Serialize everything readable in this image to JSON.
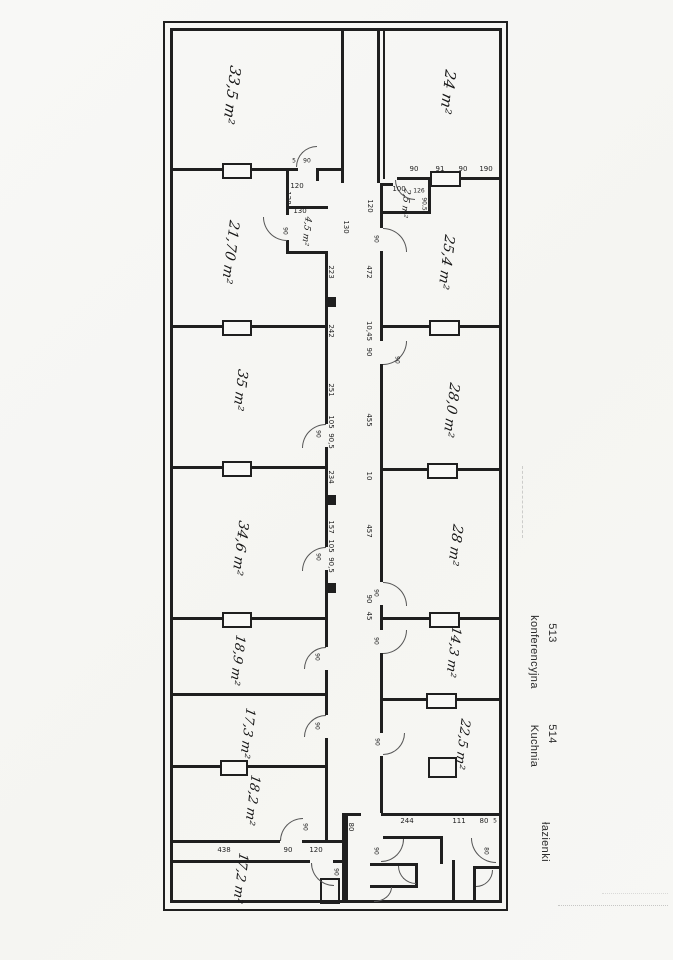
{
  "rooms": {
    "a335": "33,5 m²",
    "a24": "24 m²",
    "a2170": "21,70 m²",
    "a45": "4,5 m²",
    "a25": "2,5 m²",
    "a254": "25,4 m²",
    "a35": "35 m²",
    "a280": "28,0 m²",
    "a346": "34,6 m²",
    "a28": "28 m²",
    "a189": "18,9 m²",
    "a143": "14,3 m²",
    "a173": "17,3 m²",
    "a225": "22,5 m²",
    "a182": "18,2 m²",
    "a172": "17,2 m²"
  },
  "side_labels": {
    "room1_number": "513",
    "room1_name": "konferencyjna",
    "room2_number": "514",
    "room2_name": "Kuchnia",
    "bath": "łazienki"
  },
  "dims": {
    "corridor_left": [
      "130",
      "223",
      "242",
      "251",
      "105",
      "90,5",
      "234",
      "157",
      "105",
      "90,5"
    ],
    "corridor_right": [
      "120",
      "472",
      "10,45",
      "90",
      "455",
      "10",
      "457",
      "90",
      "45"
    ],
    "top_right_row": [
      "90",
      "91",
      "90",
      "190"
    ],
    "top_left": {
      "w1": "120",
      "h1": "128",
      "w2": "130",
      "v90": "90"
    },
    "door33": {
      "a": "5",
      "b": "90"
    },
    "closet2": {
      "w": "100",
      "t": "126",
      "h": "90,5"
    },
    "bottom_row": [
      "438",
      "90",
      "120"
    ],
    "bath_row": [
      "244",
      "111",
      "80",
      "5"
    ],
    "bath_left_h": "80",
    "door": "90",
    "door_b": "80"
  }
}
